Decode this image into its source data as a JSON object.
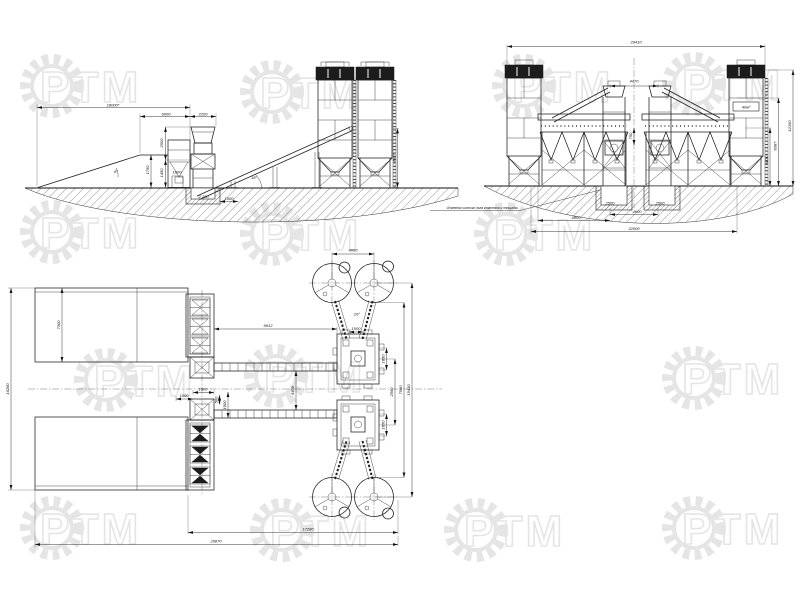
{
  "watermark": {
    "text": "РТМ",
    "color": "#e5e5e5"
  },
  "side_view": {
    "dims": {
      "overall": "18000*",
      "bins": "6000",
      "mixer": "2200",
      "h1": "2500",
      "h2": "1450",
      "h3": "1750",
      "chute": "1000",
      "pit_level": "-2.200",
      "pit_w": "1500",
      "ramp_angle": "8°",
      "belt_angle": "18°",
      "silo_h": "4387"
    }
  },
  "front_view": {
    "dims": {
      "overall": "29410",
      "towers_cc": "4470",
      "center_gap": "750",
      "silo_volume": "40м³",
      "pit_l": "2500",
      "pit_r": "2500",
      "pits_cc": "4600",
      "offset": "6800",
      "base": "22000",
      "h1": "6030",
      "h2": "8387",
      "h3": "12150"
    },
    "note": "Отметка чистого пола комплекса и площадки"
  },
  "plan_view": {
    "dims": {
      "silos_cc": "4000",
      "belt_len": "9912",
      "screw_angle": "26°",
      "screw_cc": "1500",
      "bin_h": "7300",
      "left_h": "16280",
      "f1": "1500",
      "f2": "1000",
      "f3": "500",
      "f4": "1500",
      "belts_cc": "4400",
      "m1": "1850",
      "m2": "1850",
      "mixers_cc": "2560",
      "r1": "7580",
      "r2": "15430",
      "b1": "17280",
      "b2": "29870"
    }
  }
}
